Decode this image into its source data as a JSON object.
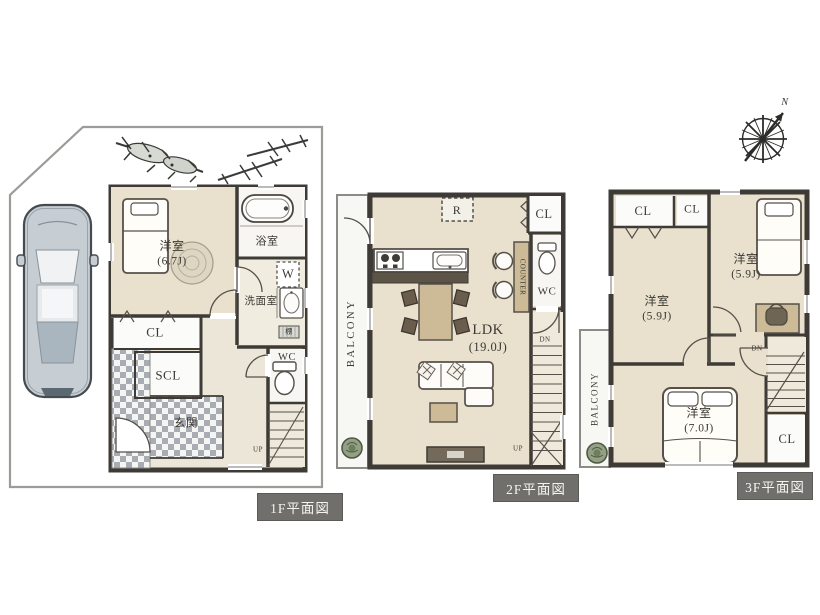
{
  "floor1": {
    "caption": "1F平面図",
    "bedroom": {
      "name": "洋室",
      "size": "(6.7J)"
    },
    "bath": "浴室",
    "washer": "W",
    "washroom": "洗面室",
    "shelf": "棚",
    "closet": "CL",
    "shoe_closet": "SCL",
    "entrance": "玄関",
    "wc": "WC",
    "stairs_up": "UP"
  },
  "floor2": {
    "caption": "2F平面図",
    "balcony": "BALCONY",
    "refrigerator": "R",
    "closet": "CL",
    "ldk": {
      "name": "LDK",
      "size": "(19.0J)"
    },
    "counter": "COUNTER",
    "wc": "WC",
    "stairs_dn": "DN",
    "stairs_up": "UP"
  },
  "floor3": {
    "caption": "3F平面図",
    "closet_a": "CL",
    "closet_b": "CL",
    "closet_c": "CL",
    "bedroom_left": {
      "name": "洋室",
      "size": "(5.9J)"
    },
    "bedroom_right": {
      "name": "洋室",
      "size": "(5.9J)"
    },
    "bedroom_main": {
      "name": "洋室",
      "size": "(7.0J)"
    },
    "balcony": "BALCONY",
    "stairs_dn": "DN"
  },
  "compass": {
    "north": "N"
  },
  "colors": {
    "floor_beige": "#e9e1ce",
    "wall_dark": "#3e3b37",
    "caption_bg": "#716f6c",
    "furniture_tan": "#cdbb97",
    "counter_dark": "#5d5448",
    "tile_grey": "#a7adb2"
  }
}
